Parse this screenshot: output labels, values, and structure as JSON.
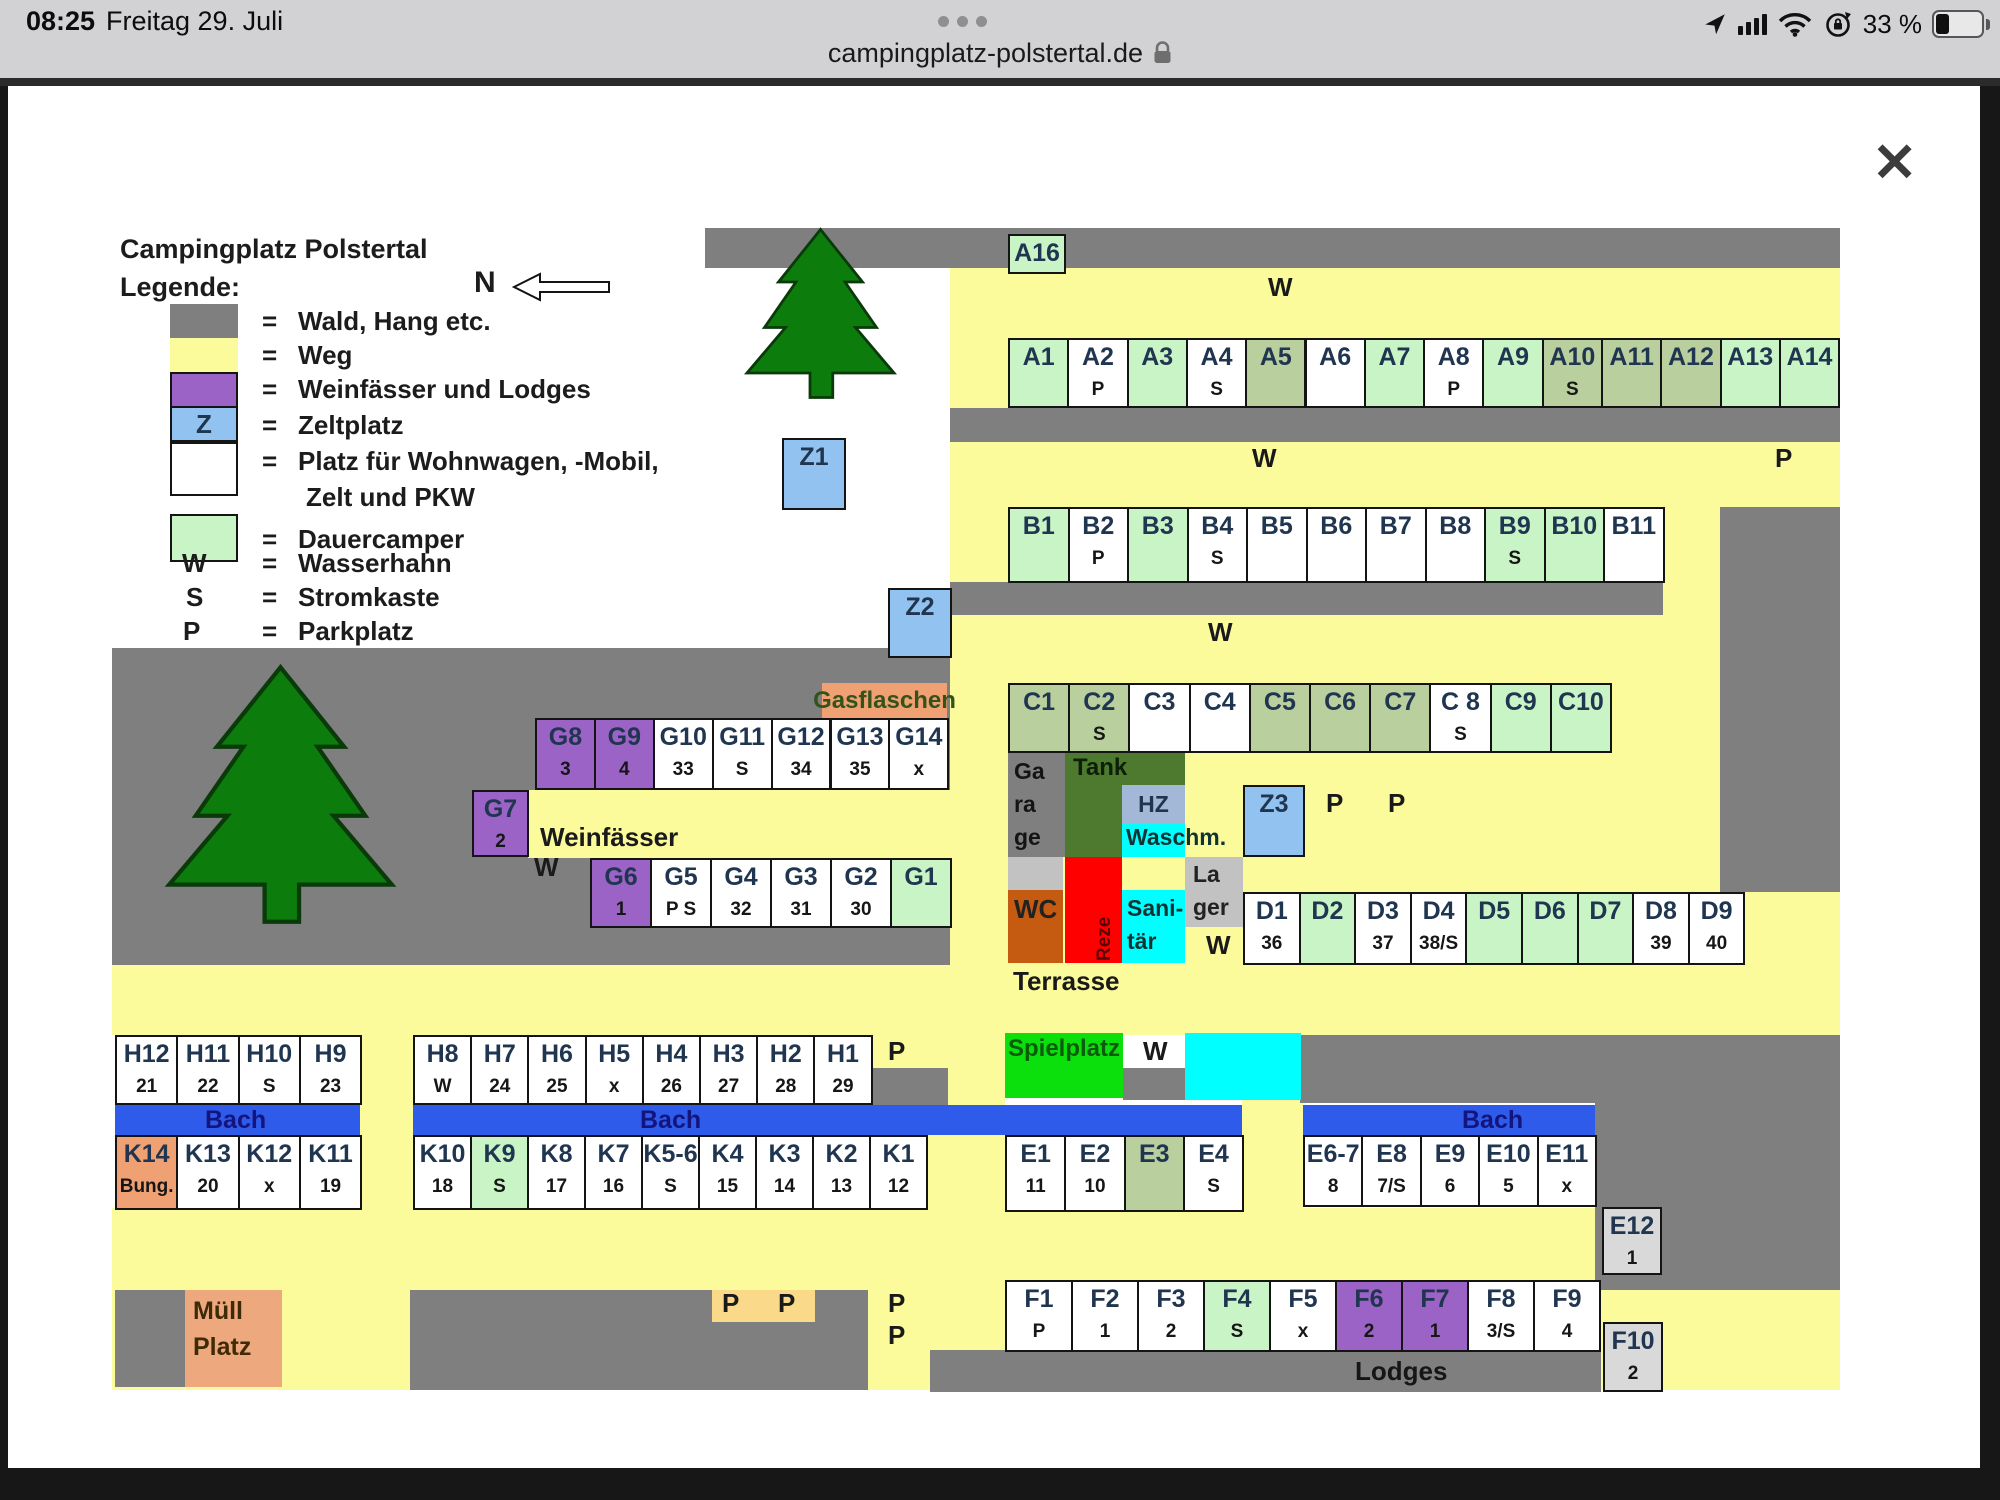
{
  "status_bar": {
    "time": "08:25",
    "date": "Freitag 29. Juli",
    "battery_percent": "33 %"
  },
  "browser": {
    "url": "campingplatz-polstertal.de",
    "close_glyph": "✕"
  },
  "map": {
    "title": "Campingplatz Polstertal",
    "legend_heading": "Legende:",
    "north_label": "N",
    "eq": "=",
    "legend": [
      {
        "swatch": "gray",
        "swatch_text": "",
        "label": "Wald, Hang etc."
      },
      {
        "swatch": "yellow",
        "swatch_text": "",
        "label": "Weg"
      },
      {
        "swatch": "purple",
        "swatch_text": "",
        "label": "Weinfässer und Lodges"
      },
      {
        "swatch": "blue",
        "swatch_text": "Z",
        "label": "Zeltplatz"
      },
      {
        "swatch": "white",
        "swatch_text": "",
        "label": "Platz für Wohnwagen, -Mobil,",
        "label2": "Zelt und PKW"
      },
      {
        "swatch": "green",
        "swatch_text": "",
        "label": "Dauercamper"
      },
      {
        "swatch": "none",
        "swatch_text": "W",
        "label": "Wasserhahn"
      },
      {
        "swatch": "none",
        "swatch_text": "S",
        "label": "Stromkaste"
      },
      {
        "swatch": "none",
        "swatch_text": "P",
        "label": "Parkplatz"
      }
    ],
    "bach_label": "Bach",
    "rows": {
      "A": [
        {
          "id": "A1",
          "sub": "",
          "t": "g"
        },
        {
          "id": "A2",
          "sub": "P",
          "t": "w"
        },
        {
          "id": "A3",
          "sub": "",
          "t": "g"
        },
        {
          "id": "A4",
          "sub": "S",
          "t": "w"
        },
        {
          "id": "A5",
          "sub": "",
          "t": "o"
        },
        {
          "id": "A6",
          "sub": "",
          "t": "w"
        },
        {
          "id": "A7",
          "sub": "",
          "t": "g"
        },
        {
          "id": "A8",
          "sub": "P",
          "t": "w"
        },
        {
          "id": "A9",
          "sub": "",
          "t": "g"
        },
        {
          "id": "A10",
          "sub": "S",
          "t": "o"
        },
        {
          "id": "A11",
          "sub": "",
          "t": "o"
        },
        {
          "id": "A12",
          "sub": "",
          "t": "o"
        },
        {
          "id": "A13",
          "sub": "",
          "t": "g"
        },
        {
          "id": "A14",
          "sub": "",
          "t": "g"
        }
      ],
      "B": [
        {
          "id": "B1",
          "sub": "",
          "t": "g"
        },
        {
          "id": "B2",
          "sub": "P",
          "t": "w"
        },
        {
          "id": "B3",
          "sub": "",
          "t": "g"
        },
        {
          "id": "B4",
          "sub": "S",
          "t": "w"
        },
        {
          "id": "B5",
          "sub": "",
          "t": "w"
        },
        {
          "id": "B6",
          "sub": "",
          "t": "w"
        },
        {
          "id": "B7",
          "sub": "",
          "t": "w"
        },
        {
          "id": "B8",
          "sub": "",
          "t": "w"
        },
        {
          "id": "B9",
          "sub": "S",
          "t": "g"
        },
        {
          "id": "B10",
          "sub": "",
          "t": "g"
        },
        {
          "id": "B11",
          "sub": "",
          "t": "w"
        }
      ],
      "C": [
        {
          "id": "C1",
          "sub": "",
          "t": "o"
        },
        {
          "id": "C2",
          "sub": "S",
          "t": "o"
        },
        {
          "id": "C3",
          "sub": "",
          "t": "w"
        },
        {
          "id": "C4",
          "sub": "",
          "t": "w"
        },
        {
          "id": "C5",
          "sub": "",
          "t": "o"
        },
        {
          "id": "C6",
          "sub": "",
          "t": "o"
        },
        {
          "id": "C7",
          "sub": "",
          "t": "o"
        },
        {
          "id": "C 8",
          "sub": "S",
          "t": "w"
        },
        {
          "id": "C9",
          "sub": "",
          "t": "g"
        },
        {
          "id": "C10",
          "sub": "",
          "t": "g"
        }
      ],
      "D": [
        {
          "id": "D1",
          "sub": "36",
          "t": "w"
        },
        {
          "id": "D2",
          "sub": "",
          "t": "g"
        },
        {
          "id": "D3",
          "sub": "37",
          "t": "w"
        },
        {
          "id": "D4",
          "sub": "38/S",
          "t": "w"
        },
        {
          "id": "D5",
          "sub": "",
          "t": "g"
        },
        {
          "id": "D6",
          "sub": "",
          "t": "g"
        },
        {
          "id": "D7",
          "sub": "",
          "t": "g"
        },
        {
          "id": "D8",
          "sub": "39",
          "t": "w"
        },
        {
          "id": "D9",
          "sub": "40",
          "t": "w"
        }
      ],
      "G_upper": [
        {
          "id": "G8",
          "sub": "3",
          "t": "p"
        },
        {
          "id": "G9",
          "sub": "4",
          "t": "p"
        },
        {
          "id": "G10",
          "sub": "33",
          "t": "w"
        },
        {
          "id": "G11",
          "sub": "S",
          "t": "w"
        },
        {
          "id": "G12",
          "sub": "34",
          "t": "w"
        },
        {
          "id": "G13",
          "sub": "35",
          "t": "w"
        },
        {
          "id": "G14",
          "sub": "x",
          "t": "w"
        }
      ],
      "G_lower": [
        {
          "id": "G6",
          "sub": "1",
          "t": "p"
        },
        {
          "id": "G5",
          "sub": "P S",
          "t": "w"
        },
        {
          "id": "G4",
          "sub": "32",
          "t": "w"
        },
        {
          "id": "G3",
          "sub": "31",
          "t": "w"
        },
        {
          "id": "G2",
          "sub": "30",
          "t": "w"
        },
        {
          "id": "G1",
          "sub": "",
          "t": "g"
        }
      ],
      "H_left": [
        {
          "id": "H12",
          "sub": "21",
          "t": "w"
        },
        {
          "id": "H11",
          "sub": "22",
          "t": "w"
        },
        {
          "id": "H10",
          "sub": "S",
          "t": "w"
        },
        {
          "id": "H9",
          "sub": "23",
          "t": "w"
        }
      ],
      "H_mid": [
        {
          "id": "H8",
          "sub": "W",
          "t": "w"
        },
        {
          "id": "H7",
          "sub": "24",
          "t": "w"
        },
        {
          "id": "H6",
          "sub": "25",
          "t": "w"
        },
        {
          "id": "H5",
          "sub": "x",
          "t": "w"
        },
        {
          "id": "H4",
          "sub": "26",
          "t": "w"
        },
        {
          "id": "H3",
          "sub": "27",
          "t": "w"
        },
        {
          "id": "H2",
          "sub": "28",
          "t": "w"
        },
        {
          "id": "H1",
          "sub": "29",
          "t": "w"
        }
      ],
      "K_left": [
        {
          "id": "K14",
          "sub": "Bung.",
          "t": "or"
        },
        {
          "id": "K13",
          "sub": "20",
          "t": "w"
        },
        {
          "id": "K12",
          "sub": "x",
          "t": "w"
        },
        {
          "id": "K11",
          "sub": "19",
          "t": "w"
        }
      ],
      "K_mid": [
        {
          "id": "K10",
          "sub": "18",
          "t": "w"
        },
        {
          "id": "K9",
          "sub": "S",
          "t": "g"
        },
        {
          "id": "K8",
          "sub": "17",
          "t": "w"
        },
        {
          "id": "K7",
          "sub": "16",
          "t": "w"
        },
        {
          "id": "K5-6",
          "sub": "S",
          "t": "w"
        },
        {
          "id": "K4",
          "sub": "15",
          "t": "w"
        },
        {
          "id": "K3",
          "sub": "14",
          "t": "w"
        },
        {
          "id": "K2",
          "sub": "13",
          "t": "w"
        },
        {
          "id": "K1",
          "sub": "12",
          "t": "w"
        }
      ],
      "E_left": [
        {
          "id": "E1",
          "sub": "11",
          "t": "w"
        },
        {
          "id": "E2",
          "sub": "10",
          "t": "w"
        },
        {
          "id": "E3",
          "sub": "",
          "t": "o"
        },
        {
          "id": "E4",
          "sub": "S",
          "t": "w"
        }
      ],
      "E_right": [
        {
          "id": "E6-7",
          "sub": "8",
          "t": "w"
        },
        {
          "id": "E8",
          "sub": "7/S",
          "t": "w"
        },
        {
          "id": "E9",
          "sub": "6",
          "t": "w"
        },
        {
          "id": "E10",
          "sub": "5",
          "t": "w"
        },
        {
          "id": "E11",
          "sub": "x",
          "t": "w"
        }
      ],
      "F": [
        {
          "id": "F1",
          "sub": "P",
          "t": "w"
        },
        {
          "id": "F2",
          "sub": "1",
          "t": "w"
        },
        {
          "id": "F3",
          "sub": "2",
          "t": "w"
        },
        {
          "id": "F4",
          "sub": "S",
          "t": "g"
        },
        {
          "id": "F5",
          "sub": "x",
          "t": "w"
        },
        {
          "id": "F6",
          "sub": "2",
          "t": "p"
        },
        {
          "id": "F7",
          "sub": "1",
          "t": "p"
        },
        {
          "id": "F8",
          "sub": "3/S",
          "t": "w"
        },
        {
          "id": "F9",
          "sub": "4",
          "t": "w"
        }
      ]
    },
    "singles": [
      {
        "key": "A16",
        "id": "A16",
        "sub": "",
        "t": "g"
      },
      {
        "key": "Z1",
        "id": "Z1",
        "sub": "",
        "t": "z"
      },
      {
        "key": "Z2",
        "id": "Z2",
        "sub": "",
        "t": "z"
      },
      {
        "key": "Z3",
        "id": "Z3",
        "sub": "",
        "t": "z"
      },
      {
        "key": "G7",
        "id": "G7",
        "sub": "2",
        "t": "p"
      },
      {
        "key": "E12",
        "id": "E12",
        "sub": "1",
        "t": "gray"
      },
      {
        "key": "F10",
        "id": "F10",
        "sub": "2",
        "t": "gray"
      }
    ],
    "facilities": {
      "gasflaschen": "Gasflaschen",
      "garage": [
        "Ga",
        "ra",
        "ge"
      ],
      "tank": "Tank",
      "hz": "HZ",
      "waschm": "Waschm.",
      "wc": "WC",
      "rezeption": "Reze",
      "sanitaer": [
        "Sani-",
        "tär"
      ],
      "lager": [
        "La",
        "ger"
      ],
      "terrasse": "Terrasse",
      "spielplatz": "Spielplatz",
      "muell": [
        "Müll",
        "Platz"
      ],
      "lodges": "Lodges",
      "weinfaesser": "Weinfässer"
    },
    "path_labels": {
      "w_top": "W",
      "w_band2": "W",
      "p_band2": "P",
      "w_band3": "W",
      "w_g": "W",
      "w_lager": "W",
      "w_spielplatz": "W",
      "p_h": "P",
      "p_z3_1": "P",
      "p_z3_2": "P",
      "p_stack_1": "P",
      "p_stack_2": "P",
      "p_beige_1": "P",
      "p_beige_2": "P"
    },
    "colors": {
      "forest": "#7f7f7f",
      "path": "#fbfb9b",
      "purple": "#9b63c6",
      "tent_blue": "#92c3f0",
      "perm_green": "#c9f4c6",
      "olive_green": "#b9cf9e",
      "stream_blue": "#2e5be9",
      "play_green": "#0ce00c",
      "pool_cyan": "#00ffff",
      "reception_red": "#ff0000",
      "wc_orange": "#c55a11",
      "gas_orange": "#f0a173",
      "parking_beige": "#fbd98b"
    }
  }
}
